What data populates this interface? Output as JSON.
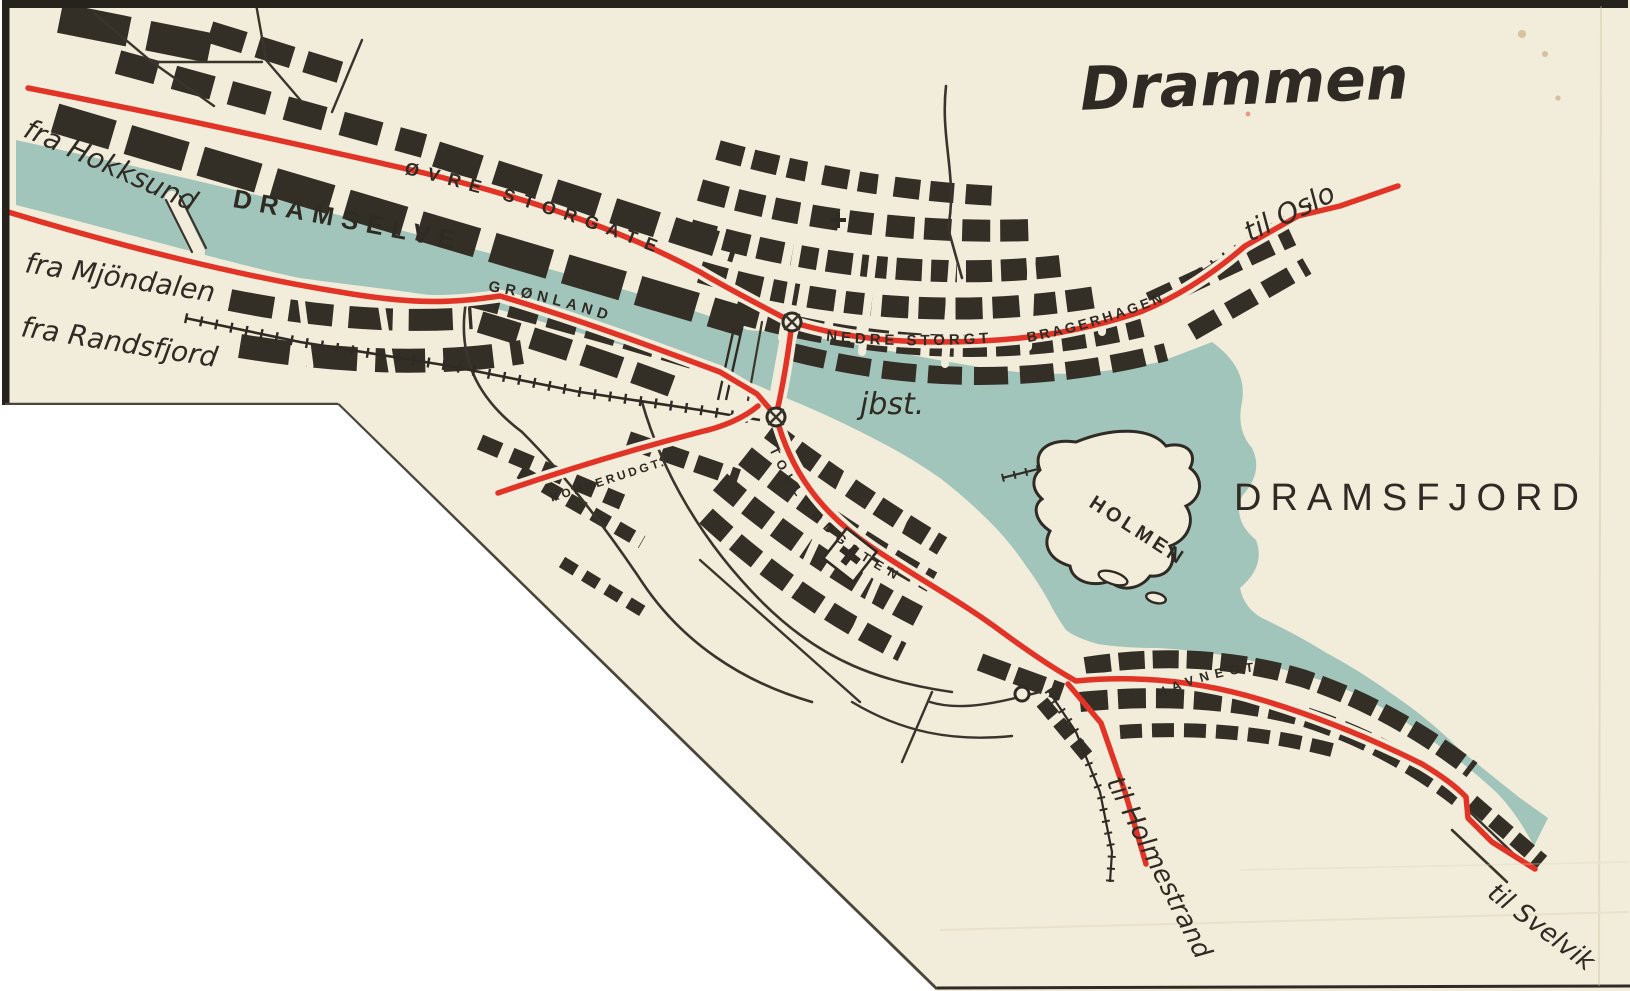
{
  "title": "Drammen",
  "colors": {
    "paper": "#f2ecda",
    "water": "#a2c5bb",
    "ink": "#2f2b24",
    "route_red": "#e23327",
    "background": "#ffffff"
  },
  "water": {
    "river": "DRAMSELVEN",
    "fjord": "DRAMSFJORD",
    "island": "HOLMEN"
  },
  "station": {
    "abbr": "jbst."
  },
  "streets": {
    "ovre_storgate": "ØVRE STORGATE",
    "nedre_storgt": "NEDRE STORGT",
    "bragerhagen": "BRAGERHAGEN",
    "gronland": "GRØNLAND",
    "konnerudgt": "KONNERUDGT.",
    "tollbodgaten": "TOLLBODGATEN",
    "havnegt": "HAVNEGT."
  },
  "directions": {
    "hokksund": "fra Hokksund",
    "mjondalen": "fra Mjöndalen",
    "randsfjord": "fra Randsfjord",
    "oslo": "til Oslo",
    "holmestrand": "til Holmestrand",
    "svelvik": "til Svelvik"
  }
}
